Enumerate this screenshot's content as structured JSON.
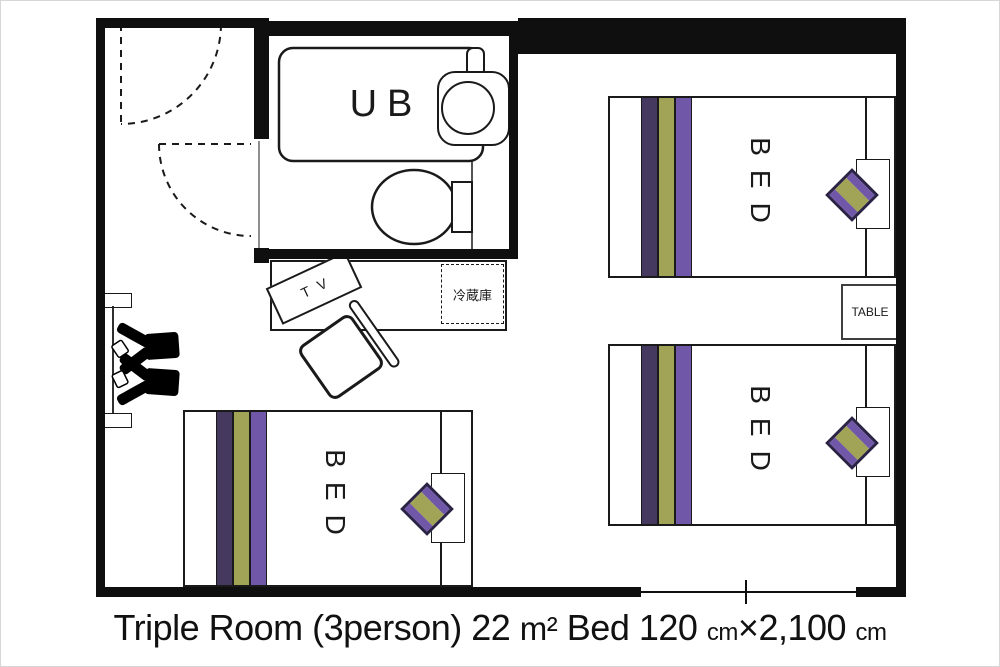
{
  "room": {
    "caption": {
      "full": "Triple Room (3person) 22 ㎡ Bed 120 ㎝×2,100 ㎝",
      "part1": "Triple Room (3person) 22 ",
      "unit_m2": "m²",
      "part2": " Bed 120 ",
      "unit_cm_1": "cm",
      "times": "×",
      "part3": "2,100 ",
      "unit_cm_2": "cm"
    },
    "labels": {
      "unit_bath": "UB",
      "tv": "TV",
      "refrigerator": "冷蔵庫",
      "table": "TABLE"
    },
    "beds": [
      {
        "id": "bed-top-right",
        "label": "BED"
      },
      {
        "id": "bed-bottom-right",
        "label": "BED"
      },
      {
        "id": "bed-bottom-left",
        "label": "BED"
      }
    ],
    "colors": {
      "stripe_dark_purple": "#46395f",
      "stripe_olive": "#a1a356",
      "stripe_purple": "#7157a7",
      "pillow_border": "#2b2346",
      "line": "#1a1a1a"
    },
    "icons": {
      "entry_door": "dashed-swing-arc",
      "bathroom_door": "dashed-swing-arc",
      "bathtub": "rounded-rect",
      "washbasin": "circle-in-rounded-rect",
      "toilet": "ellipse-with-tank",
      "chairs": "black-top-view-silhouette",
      "stool": "rotated-open-square",
      "window": "thin-line-with-tick"
    }
  }
}
